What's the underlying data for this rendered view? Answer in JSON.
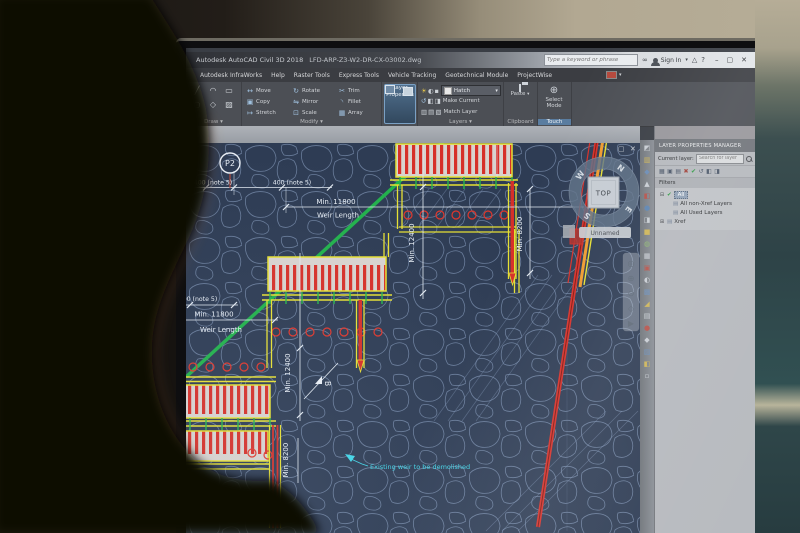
{
  "colors": {
    "cad_background": "#2e3c54",
    "rock_line": "#7e93b4",
    "structure_yellow": "#e6e033",
    "hatch_red": "#d63029",
    "marker_green": "#22b14c",
    "dimension_white": "#e3eaf2",
    "demolish_cyan": "#41d6e8",
    "ribbon_gray": "#4c4f55",
    "panel_gray": "#b5b8bd",
    "highlight_blue": "#51708e"
  },
  "titlebar": {
    "app_title": "Autodesk AutoCAD Civil 3D 2018",
    "doc_name": "LFD-ARP-Z3-W2-DR-CX-03002.dwg",
    "search_placeholder": "Type a keyword or phrase",
    "sign_in": "Sign In",
    "binocular": "∞",
    "dropdown": "▾",
    "exchange": "△",
    "help": "?",
    "minimize": "–",
    "maximize": "▢",
    "close": "✕"
  },
  "menubar": {
    "items": [
      "Autodesk InfraWorks",
      "Help",
      "Raster Tools",
      "Express Tools",
      "Vehicle Tracking",
      "Geotechnical Module",
      "ProjectWise"
    ],
    "overflow": "▾"
  },
  "ribbon": {
    "draw": {
      "label": "Draw ▾",
      "icons": [
        {
          "glyph": "╱",
          "icon": "line-icon"
        },
        {
          "glyph": "◠",
          "icon": "arc-icon"
        },
        {
          "glyph": "▭",
          "icon": "rectangle-icon"
        },
        {
          "glyph": "○",
          "icon": "circle-icon"
        },
        {
          "glyph": "◇",
          "icon": "polyline-icon"
        },
        {
          "glyph": "▨",
          "icon": "hatch-icon"
        }
      ]
    },
    "modify": {
      "label": "Modify ▾",
      "buttons": [
        {
          "glyph": "↔",
          "label": "Move",
          "icon": "move-icon"
        },
        {
          "glyph": "▣",
          "label": "Copy",
          "icon": "copy-icon"
        },
        {
          "glyph": "↦",
          "label": "Stretch",
          "icon": "stretch-icon"
        },
        {
          "glyph": "↻",
          "label": "Rotate",
          "icon": "rotate-icon"
        },
        {
          "glyph": "⇋",
          "label": "Mirror",
          "icon": "mirror-icon"
        },
        {
          "glyph": "⊡",
          "label": "Scale",
          "icon": "scale-icon"
        },
        {
          "glyph": "✂",
          "label": "Trim",
          "icon": "trim-icon"
        },
        {
          "glyph": "◝",
          "label": "Fillet",
          "icon": "fillet-icon"
        },
        {
          "glyph": "▦",
          "label": "Array",
          "icon": "array-icon"
        }
      ]
    },
    "layer_properties": {
      "line1": "Layer",
      "line2": "Properties"
    },
    "layers": {
      "label": "Layers ▾",
      "state_icons": [
        {
          "glyph": "☀",
          "icon": "layer-on-icon",
          "color": "#e8c84a"
        },
        {
          "glyph": "◐",
          "icon": "layer-freeze-icon",
          "color": "#cdd2d8"
        },
        {
          "glyph": "▪",
          "icon": "layer-lock-icon",
          "color": "#cdd2d8"
        }
      ],
      "dropdown_value": "Hatch",
      "dropdown_arrow": "▾",
      "row2_icons": [
        {
          "glyph": "↺",
          "icon": "layer-prev-icon",
          "color": "#9fc0de"
        },
        {
          "glyph": "◧",
          "icon": "layer-iso-icon",
          "color": "#cdd2d8"
        },
        {
          "glyph": "◨",
          "icon": "layer-uniso-icon",
          "color": "#cdd2d8"
        }
      ],
      "row3_icons": [
        {
          "glyph": "▥",
          "icon": "layer-off-icon",
          "color": "#cdd2d8"
        },
        {
          "glyph": "▤",
          "icon": "layer-freeze2-icon",
          "color": "#cdd2d8"
        },
        {
          "glyph": "▧",
          "icon": "layer-walk-icon",
          "color": "#cdd2d8"
        }
      ],
      "make_current": "Make Current",
      "match_layer": "Match Layer"
    },
    "clipboard": {
      "label": "Clipboard",
      "paste": "Paste",
      "dropdown": "▾"
    },
    "touch": {
      "label": "Touch",
      "icon_glyph": "⊕",
      "line1": "Select",
      "line2": "Mode"
    }
  },
  "layer_manager": {
    "title": "LAYER PROPERTIES MANAGER",
    "current_layer_label": "Current layer:",
    "search_placeholder": "Search for layer",
    "toolbar_icons": [
      {
        "glyph": "▦",
        "icon": "new-filter-icon"
      },
      {
        "glyph": "▣",
        "icon": "new-layer-icon"
      },
      {
        "glyph": "▤",
        "icon": "new-vp-layer-icon"
      },
      {
        "glyph": "✖",
        "icon": "delete-layer-icon",
        "color": "#a04038"
      },
      {
        "glyph": "✔",
        "icon": "set-current-icon",
        "color": "#2f9a43"
      },
      {
        "glyph": "↺",
        "icon": "refresh-icon"
      },
      {
        "glyph": "◧",
        "icon": "settings-icon"
      },
      {
        "glyph": "◨",
        "icon": "state-icon"
      }
    ],
    "filters_label": "Filters",
    "tree": {
      "root_expander": "⊟",
      "root_check": "✔",
      "root_label": "All",
      "child1": "All non-Xref Layers",
      "child2": "All Used Layers",
      "xref_expander": "⊞",
      "xref_label": "Xref",
      "folder_glyph": "▤"
    }
  },
  "icon_strip": {
    "glyphs": [
      {
        "glyph": "◩",
        "color": "#c8cdd3"
      },
      {
        "glyph": "▥",
        "color": "#cdb458"
      },
      {
        "glyph": "◆",
        "color": "#6b8cb5"
      },
      {
        "glyph": "▲",
        "color": "#c8cdd3"
      },
      {
        "glyph": "◧",
        "color": "#b5524a"
      },
      {
        "glyph": "●",
        "color": "#5d84b0"
      },
      {
        "glyph": "◨",
        "color": "#c8cdd3"
      },
      {
        "glyph": "■",
        "color": "#cdb458"
      },
      {
        "glyph": "◍",
        "color": "#8fb573"
      },
      {
        "glyph": "▦",
        "color": "#c8cdd3"
      },
      {
        "glyph": "▣",
        "color": "#b5524a"
      },
      {
        "glyph": "◐",
        "color": "#c8cdd3"
      },
      {
        "glyph": "▩",
        "color": "#6b8cb5"
      },
      {
        "glyph": "◢",
        "color": "#cdb458"
      },
      {
        "glyph": "▤",
        "color": "#c8cdd3"
      },
      {
        "glyph": "●",
        "color": "#b5524a"
      },
      {
        "glyph": "◆",
        "color": "#c8cdd3"
      },
      {
        "glyph": "▨",
        "color": "#6b8cb5"
      },
      {
        "glyph": "◧",
        "color": "#cdb458"
      },
      {
        "glyph": "▫",
        "color": "#c8cdd3"
      }
    ]
  },
  "viewport": {
    "min": "–",
    "max": "▢",
    "close": "✕",
    "unnamed": "Unnamed",
    "viewcube": {
      "top": "TOP",
      "n": "N",
      "e": "E",
      "s": "S",
      "w": "W"
    },
    "navbar_icons": [
      {
        "glyph": "◎",
        "icon": "steering-wheel-icon"
      },
      {
        "glyph": "⊕",
        "icon": "pan-icon"
      },
      {
        "glyph": "⊙",
        "icon": "zoom-icon"
      },
      {
        "glyph": "◇",
        "icon": "orbit-icon"
      },
      {
        "glyph": "▶",
        "icon": "showmotion-icon"
      }
    ]
  },
  "drawing": {
    "p2": "P2",
    "note400_a": "400 (note 5)",
    "note400_b": "400 (note 5)",
    "note400_c": "400 (note 5)",
    "min11800_a": "Min. 11800",
    "weir_length_a": "Weir Length",
    "min11800_b": "Min. 11800",
    "weir_length_b": "Weir Length",
    "min12400_a": "Min. 12400",
    "min8200_a": "Min. 8200",
    "min12400_b": "Min. 12400",
    "min8200_b": "Min. 8200",
    "section_b": "B",
    "demolish_note": "Existing weir to be demolished"
  }
}
